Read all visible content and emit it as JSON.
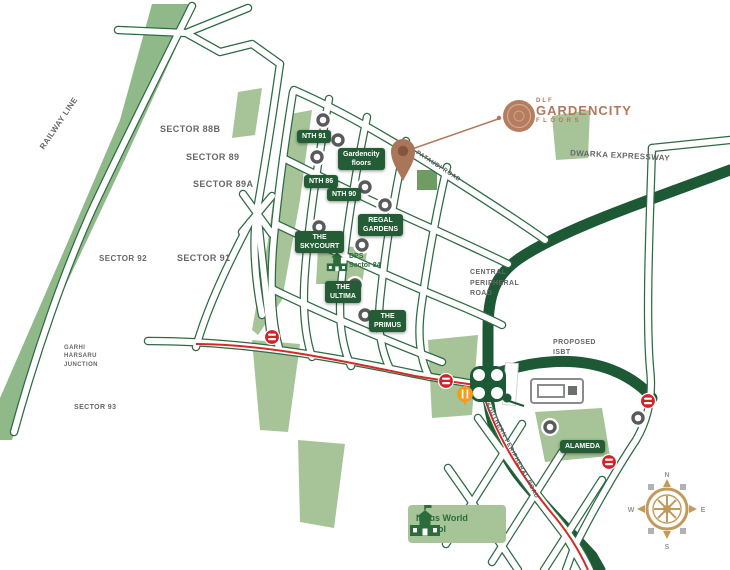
{
  "page": {
    "background": "#ffffff"
  },
  "logo": {
    "brand_top": "DLF",
    "brand": "GARDENCITY",
    "brand_sub": "FLOORS"
  },
  "projects": [
    {
      "name": "nth-91",
      "label": "NTH 91"
    },
    {
      "name": "gardencity-floors",
      "label": "Gardencity\nfloors"
    },
    {
      "name": "nth-86",
      "label": "NTH 86"
    },
    {
      "name": "nth-90",
      "label": "NTH 90"
    },
    {
      "name": "regal-gardens",
      "label": "REGAL\nGARDENS"
    },
    {
      "name": "the-skycourt",
      "label": "THE\nSKYCOURT"
    },
    {
      "name": "the-ultima",
      "label": "THE\nULTIMA"
    },
    {
      "name": "the-primus",
      "label": "THE\nPRIMUS"
    },
    {
      "name": "alameda",
      "label": "ALAMEDA"
    }
  ],
  "schools": [
    {
      "name": "dps-sector-84",
      "label": "DPS\nSector 84"
    },
    {
      "name": "indus-world-school",
      "label": "Indus World\nSchool"
    }
  ],
  "road_names": [
    {
      "name": "pataudi-road",
      "label": "PATAUDI ROAD"
    },
    {
      "name": "southern-peripheral-road",
      "label": "SOUTHERN PERIPHERAL ROAD"
    }
  ],
  "area_labels": [
    {
      "name": "railway-line",
      "label": "RAILWAY LINE"
    },
    {
      "name": "sector-88b",
      "label": "SECTOR 88B"
    },
    {
      "name": "sector-89",
      "label": "SECTOR 89"
    },
    {
      "name": "sector-89a",
      "label": "SECTOR 89A"
    },
    {
      "name": "sector-92",
      "label": "SECTOR 92"
    },
    {
      "name": "sector-91",
      "label": "SECTOR 91"
    },
    {
      "name": "garhi-harsaru",
      "label": "GARHI\nHARSARU\nJUNCTION"
    },
    {
      "name": "sector-93",
      "label": "SECTOR 93"
    },
    {
      "name": "dwarka-expressway",
      "label": "DWARKA EXPRESSWAY"
    },
    {
      "name": "central-peripheral-road",
      "label": "CENTRAL\nPERIPHERAL\nROAD"
    },
    {
      "name": "proposed-isbt",
      "label": "PROPOSED\nISBT"
    }
  ],
  "compass": {
    "n": "N",
    "e": "E",
    "s": "S",
    "w": "W"
  },
  "colors": {
    "dark_green": "#1d5935",
    "label_green": "#235c35",
    "casing_green": "#2e6a44",
    "light_green": "#a6c498",
    "strip_green": "#8fb989",
    "copper": "#b0795c",
    "red": "#d42a27",
    "orange": "#f39c1f",
    "gray_text": "#66676a",
    "gold": "#c49a5c"
  }
}
